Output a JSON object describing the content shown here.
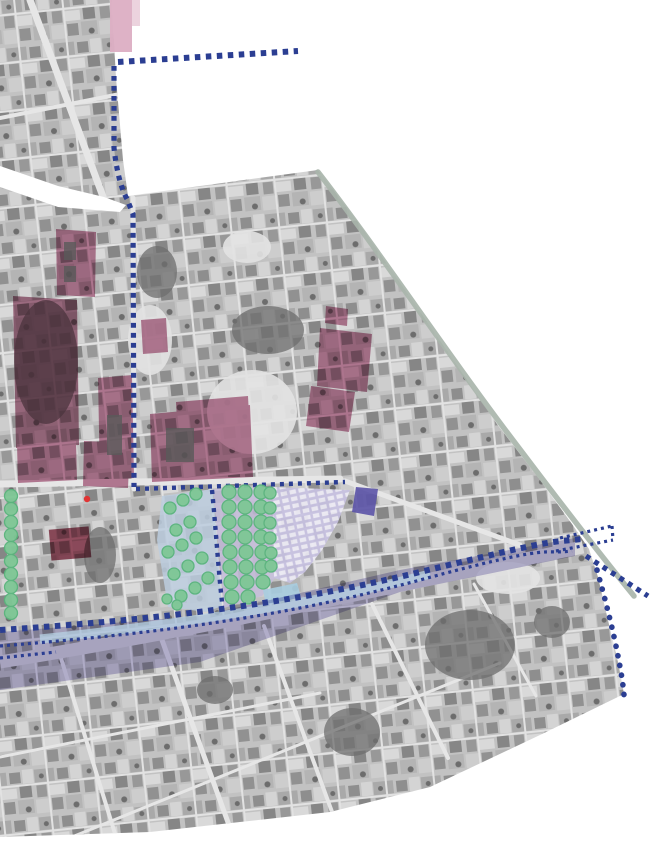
{
  "page": {
    "width": 655,
    "height": 850
  },
  "colors": {
    "background": "#ffffff",
    "photo_base": "#c2c2c2",
    "photo_dark_vegetation": "#6e6e6e",
    "photo_light_plaza": "#e3e3e3",
    "street_white": "#e6e6e6",
    "road_gray": "#d9d9d9",
    "building_pink": "#b5688a",
    "building_pink_light": "#dcaec3",
    "building_dark_red": "#8e3048",
    "garden_mauve": "#9e5a76",
    "building_indigo": "#5b53a7",
    "tree_green": "#7ec795",
    "tree_green_edge": "#59b47c",
    "market_lavender": "#c7c1e1",
    "market_stall_white": "#f1f0f8",
    "park_blue": "#bccdde",
    "parking_lavender": "#c4bcd9",
    "canal_blue": "#a8cde0",
    "road_band_purple": "#948bc4",
    "road_stripe_blue": "#b7d2e4",
    "route_navy": "#2b3e92",
    "edge_sage": "#a9b5ab",
    "marker_red": "#e03434",
    "courtyard_dark": "#5a5a5a"
  },
  "map": {
    "kind": "aerial-orthophoto-with-planning-overlays",
    "layers": [
      {
        "id": "orthophoto"
      },
      {
        "id": "pink-highlighted-buildings"
      },
      {
        "id": "garden-block"
      },
      {
        "id": "tree-canopy"
      },
      {
        "id": "market-stall-area"
      },
      {
        "id": "park-surface"
      },
      {
        "id": "parking-with-trees"
      },
      {
        "id": "road-corridor-band"
      },
      {
        "id": "dotted-route-lines"
      },
      {
        "id": "curved-edge-line"
      }
    ]
  }
}
